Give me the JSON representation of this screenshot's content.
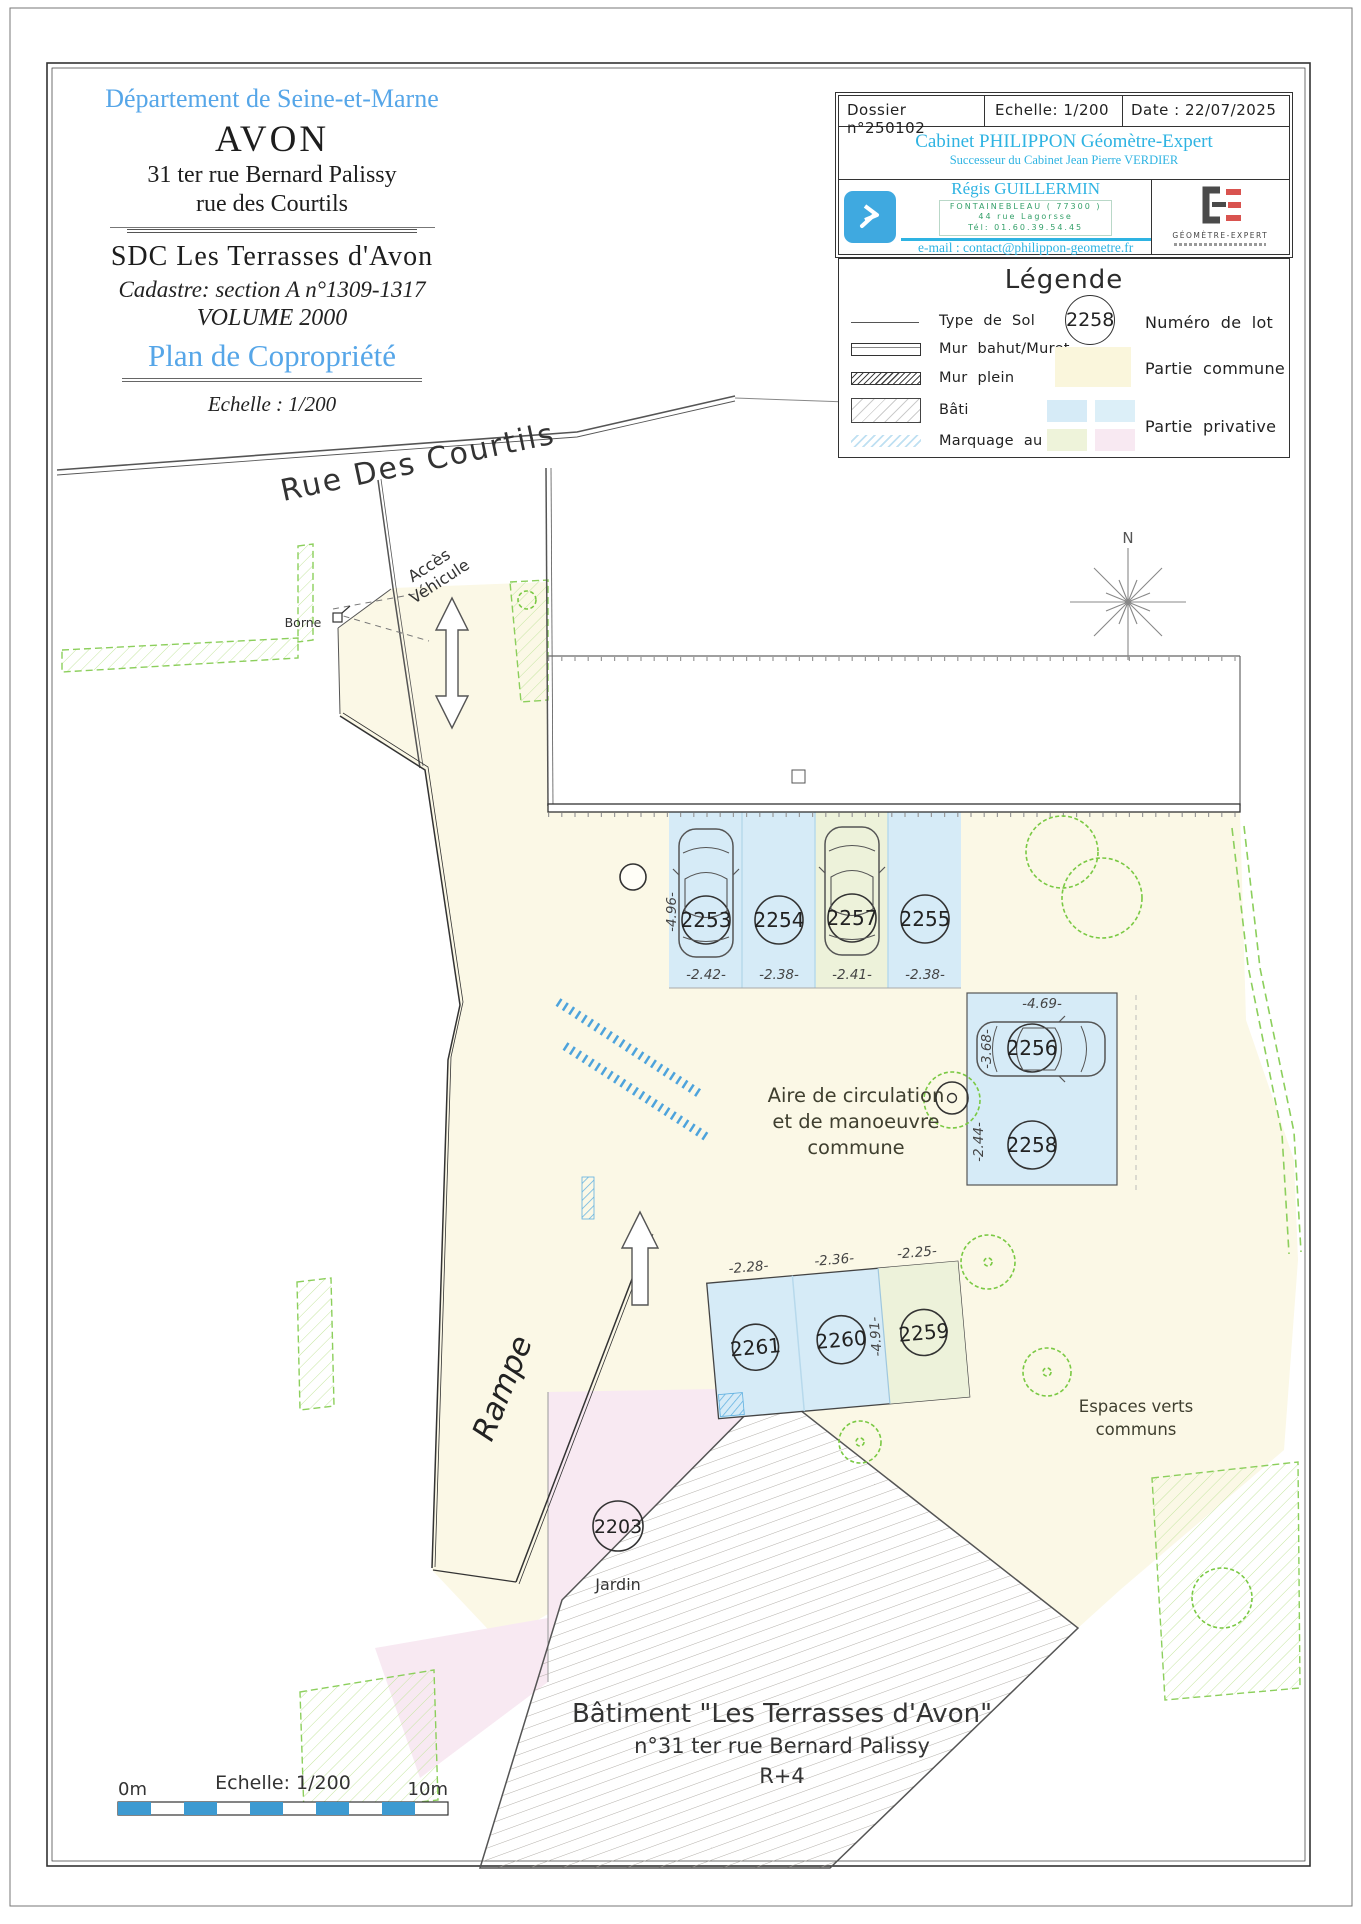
{
  "header": {
    "department": "Département de Seine-et-Marne",
    "city": "AVON",
    "address_line1": "31 ter rue Bernard Palissy",
    "address_line2": "rue des Courtils",
    "syndicate": "SDC Les Terrasses d'Avon",
    "cadastre": "Cadastre: section A n°1309-1317",
    "volume": "VOLUME 2000",
    "plan_title": "Plan de Copropriété",
    "scale_note": "Echelle : 1/200"
  },
  "title_block": {
    "dossier": "Dossier n°250102",
    "echelle": "Echelle: 1/200",
    "date": "Date : 22/07/2025",
    "cabinet": "Cabinet PHILIPPON Géomètre-Expert",
    "successor": "Successeur du Cabinet Jean Pierre VERDIER",
    "surveyor": "Régis GUILLERMIN",
    "office_city": "FONTAINEBLEAU ( 77300 )",
    "office_street": "44 rue Lagorsse",
    "office_tel": "Tél: 01.60.39.54.45",
    "email": "e-mail : contact@philippon-geometre.fr",
    "ge_label": "GÉOMÈTRE-EXPERT"
  },
  "legend": {
    "title": "Légende",
    "type_sol": "Type de Sol",
    "mur_bahut": "Mur bahut/Muret",
    "mur_plein": "Mur plein",
    "bati": "Bâti",
    "marquage": "Marquage au sol",
    "lot_sample": "2258",
    "numero_lot": "Numéro de lot",
    "partie_commune": "Partie commune",
    "partie_privative": "Partie privative"
  },
  "map": {
    "street": "Rue Des Courtils",
    "acces_line1": "Accès",
    "acces_line2": "Véhicule",
    "borne": "Borne",
    "north": "N",
    "aire_line1": "Aire de circulation",
    "aire_line2": "et de manoeuvre",
    "aire_line3": "commune",
    "rampe": "Rampe",
    "espaces_line1": "Espaces verts",
    "espaces_line2": "communs",
    "jardin_lot": "2203",
    "jardin_label": "Jardin",
    "building_line1": "Bâtiment \"Les Terrasses d'Avon\"",
    "building_line2": "n°31 ter rue Bernard Palissy",
    "building_line3": "R+4",
    "lots": [
      "2253",
      "2254",
      "2257",
      "2255",
      "2256",
      "2258",
      "2261",
      "2260",
      "2259"
    ],
    "dims": {
      "row_a_depth": "-4.96-",
      "a1": "-2.42-",
      "a2": "-2.38-",
      "a3": "-2.41-",
      "a4": "-2.38-",
      "b_width": "-4.69-",
      "b_depth": "-3.68-",
      "b2_width": "-2.44-",
      "c1": "-2.28-",
      "c2": "-2.36-",
      "c3": "-2.25-",
      "c_depth": "-4.91-"
    }
  },
  "scalebar": {
    "left": "0m",
    "label": "Echelle: 1/200",
    "right": "10m"
  },
  "colors": {
    "commune_yellow": "#fbf8e6",
    "parking_blue": "#d6ebf7",
    "parking_green": "#edf2da",
    "private_pink": "#f8e9f2",
    "cyan_text": "#2eb3e2",
    "header_blue": "#56a6e8",
    "vegetation_green": "#8ccf5c",
    "marking_blue": "#4da3dc"
  }
}
